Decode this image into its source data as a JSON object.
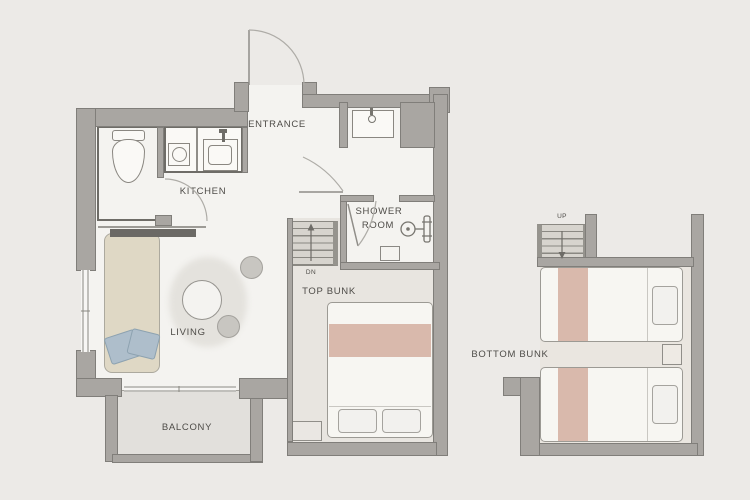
{
  "rooms": {
    "entrance": {
      "label": "ENTRANCE"
    },
    "kitchen": {
      "label": "KITCHEN"
    },
    "shower_room": {
      "label_line1": "SHOWER",
      "label_line2": "ROOM"
    },
    "living": {
      "label": "LIVING"
    },
    "balcony": {
      "label": "BALCONY"
    },
    "top_bunk": {
      "label": "TOP BUNK"
    },
    "bottom_bunk": {
      "label": "BOTTOM BUNK"
    }
  },
  "stairs": {
    "down_label": "DN",
    "up_label": "UP"
  },
  "colors": {
    "background": "#ECEAE7",
    "wallFill": "#A9A6A2",
    "wallEdge": "#807E7A",
    "floorMain": "#F4F3F0",
    "floorBunk": "#E8E5E0",
    "floorBalcony": "#E2E0DC",
    "floorRight": "#EAE6E0",
    "fixtureLine": "#6E6C67",
    "fixtureFill": "#FAF9F6",
    "bedFill": "#F7F6F2",
    "bedAccent": "#D9B9AC",
    "bedEdge": "#9C9A94",
    "sofaFill": "#DFD8C5",
    "sofaEdge": "#ACA99E",
    "cushionFill": "#AEBECB",
    "cushionEdge": "#8DA2B0",
    "rug": "#E4E2DD",
    "stool": "#C8C6C1",
    "stoolEdge": "#A3A19C",
    "stairFill": "#D7D4CE",
    "stairLine": "#8A8882",
    "text": "#4E4C48",
    "arcLine": "#AEACA7",
    "leafLine": "#8F8D88"
  }
}
